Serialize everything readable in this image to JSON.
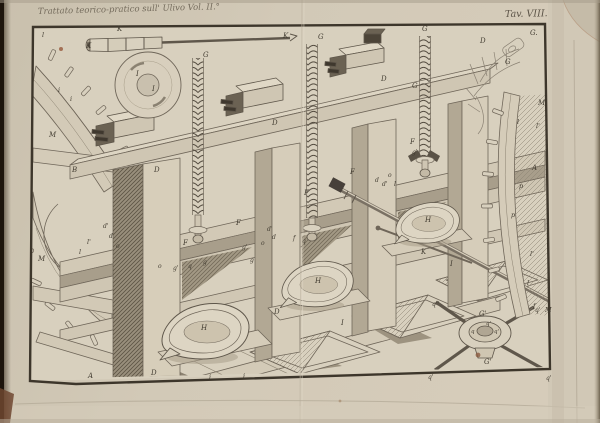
{
  "header": {
    "caption": "Trattato teorico-pratico sull' Ulivo Vol. II.°",
    "plate_number": "Tav. VIII."
  },
  "figure": {
    "labels": [
      {
        "t": "K",
        "x": 86,
        "y": 48,
        "fs": 7
      },
      {
        "t": "K",
        "x": 117,
        "y": 31,
        "fs": 7
      },
      {
        "t": "K",
        "x": 283,
        "y": 38,
        "fs": 7
      },
      {
        "t": "G",
        "x": 203,
        "y": 57,
        "fs": 7
      },
      {
        "t": "G",
        "x": 318,
        "y": 39,
        "fs": 7
      },
      {
        "t": "G",
        "x": 422,
        "y": 31,
        "fs": 7
      },
      {
        "t": "G",
        "x": 412,
        "y": 88,
        "fs": 7
      },
      {
        "t": "G.",
        "x": 530,
        "y": 35,
        "fs": 7
      },
      {
        "t": "G",
        "x": 505,
        "y": 64,
        "fs": 7
      },
      {
        "t": "D",
        "x": 480,
        "y": 43,
        "fs": 7
      },
      {
        "t": "D",
        "x": 381,
        "y": 81,
        "fs": 7
      },
      {
        "t": "D",
        "x": 272,
        "y": 125,
        "fs": 7
      },
      {
        "t": "D",
        "x": 154,
        "y": 172,
        "fs": 7
      },
      {
        "t": "B",
        "x": 72,
        "y": 172,
        "fs": 7
      },
      {
        "t": "M",
        "x": 49,
        "y": 137,
        "fs": 7
      },
      {
        "t": "M",
        "x": 38,
        "y": 261,
        "fs": 7
      },
      {
        "t": "M",
        "x": 538,
        "y": 105,
        "fs": 7
      },
      {
        "t": "M",
        "x": 545,
        "y": 312,
        "fs": 6.5
      },
      {
        "t": "i",
        "x": 58,
        "y": 92,
        "fs": 6.5
      },
      {
        "t": "i",
        "x": 70,
        "y": 101,
        "fs": 6.5
      },
      {
        "t": "l",
        "x": 42,
        "y": 37,
        "fs": 6.5
      },
      {
        "t": "l'",
        "x": 87,
        "y": 244,
        "fs": 6.5
      },
      {
        "t": "l",
        "x": 79,
        "y": 254,
        "fs": 6.5
      },
      {
        "t": "I",
        "x": 136,
        "y": 76,
        "fs": 7
      },
      {
        "t": "I",
        "x": 152,
        "y": 91,
        "fs": 7
      },
      {
        "t": "F",
        "x": 183,
        "y": 245,
        "fs": 7
      },
      {
        "t": "F",
        "x": 236,
        "y": 225,
        "fs": 7
      },
      {
        "t": "F",
        "x": 304,
        "y": 195,
        "fs": 7
      },
      {
        "t": "F",
        "x": 350,
        "y": 174,
        "fs": 7
      },
      {
        "t": "F",
        "x": 410,
        "y": 144,
        "fs": 7
      },
      {
        "t": "H",
        "x": 201,
        "y": 330,
        "fs": 7
      },
      {
        "t": "H",
        "x": 315,
        "y": 283,
        "fs": 7
      },
      {
        "t": "H",
        "x": 425,
        "y": 222,
        "fs": 7
      },
      {
        "t": "K",
        "x": 421,
        "y": 254,
        "fs": 7
      },
      {
        "t": "d'",
        "x": 103,
        "y": 228,
        "fs": 6
      },
      {
        "t": "d",
        "x": 109,
        "y": 238,
        "fs": 6
      },
      {
        "t": "o",
        "x": 116,
        "y": 248,
        "fs": 6
      },
      {
        "t": "o",
        "x": 158,
        "y": 268,
        "fs": 6
      },
      {
        "t": "g'",
        "x": 173,
        "y": 270,
        "fs": 6
      },
      {
        "t": "q",
        "x": 188,
        "y": 268,
        "fs": 6
      },
      {
        "t": "g",
        "x": 203,
        "y": 264,
        "fs": 6
      },
      {
        "t": "g'",
        "x": 242,
        "y": 249,
        "fs": 6
      },
      {
        "t": "g",
        "x": 250,
        "y": 262,
        "fs": 6
      },
      {
        "t": "o",
        "x": 261,
        "y": 245,
        "fs": 6
      },
      {
        "t": "d'",
        "x": 267,
        "y": 231,
        "fs": 6
      },
      {
        "t": "d",
        "x": 272,
        "y": 239,
        "fs": 6
      },
      {
        "t": "f",
        "x": 293,
        "y": 240,
        "fs": 6
      },
      {
        "t": "q",
        "x": 302,
        "y": 243,
        "fs": 6
      },
      {
        "t": "d",
        "x": 375,
        "y": 182,
        "fs": 6
      },
      {
        "t": "d'",
        "x": 382,
        "y": 186,
        "fs": 6
      },
      {
        "t": "o",
        "x": 388,
        "y": 177,
        "fs": 6
      },
      {
        "t": "l",
        "x": 394,
        "y": 186,
        "fs": 6
      },
      {
        "t": "g'",
        "x": 412,
        "y": 154,
        "fs": 6
      },
      {
        "t": "l",
        "x": 517,
        "y": 124,
        "fs": 6.5
      },
      {
        "t": "l'",
        "x": 536,
        "y": 128,
        "fs": 6.5
      },
      {
        "t": "A",
        "x": 532,
        "y": 170,
        "fs": 7
      },
      {
        "t": "p",
        "x": 519,
        "y": 188,
        "fs": 6.5
      },
      {
        "t": "p",
        "x": 511,
        "y": 217,
        "fs": 6.5
      },
      {
        "t": "l'",
        "x": 530,
        "y": 256,
        "fs": 6.5
      },
      {
        "t": "l",
        "x": 527,
        "y": 285,
        "fs": 6.5
      },
      {
        "t": "f",
        "x": 533,
        "y": 308,
        "fs": 6.5
      },
      {
        "t": "I",
        "x": 341,
        "y": 325,
        "fs": 7
      },
      {
        "t": "I",
        "x": 450,
        "y": 266,
        "fs": 7
      },
      {
        "t": "i",
        "x": 243,
        "y": 378,
        "fs": 6.5
      },
      {
        "t": "i",
        "x": 209,
        "y": 379,
        "fs": 6.5
      },
      {
        "t": "A",
        "x": 88,
        "y": 378,
        "fs": 7
      },
      {
        "t": "D",
        "x": 151,
        "y": 375,
        "fs": 7
      },
      {
        "t": "D",
        "x": 274,
        "y": 314,
        "fs": 7
      },
      {
        "t": "q''",
        "x": 432,
        "y": 306,
        "fs": 6
      },
      {
        "t": "q'",
        "x": 535,
        "y": 312,
        "fs": 6
      },
      {
        "t": "q'",
        "x": 428,
        "y": 379,
        "fs": 6
      },
      {
        "t": "q'",
        "x": 546,
        "y": 380,
        "fs": 6
      },
      {
        "t": "G'",
        "x": 479,
        "y": 316,
        "fs": 7
      },
      {
        "t": "G'",
        "x": 484,
        "y": 364,
        "fs": 7
      },
      {
        "t": "q'",
        "x": 494,
        "y": 333,
        "fs": 5.5
      },
      {
        "t": "q",
        "x": 471,
        "y": 333,
        "fs": 5.5
      },
      {
        "t": "q'",
        "x": 486,
        "y": 325,
        "fs": 5.5
      }
    ]
  }
}
